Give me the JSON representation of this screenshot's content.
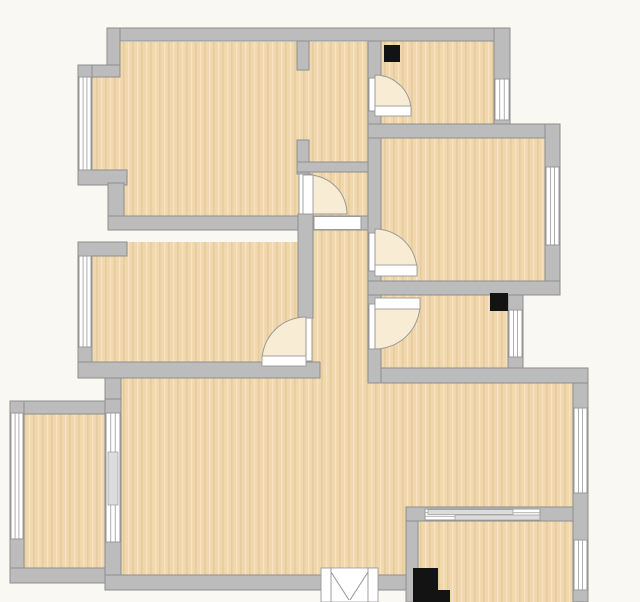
{
  "canvas": {
    "width": 640,
    "height": 602
  },
  "colors": {
    "background": "#faf8f2",
    "floor_base": "#f0d8ac",
    "floor_grain_light": "rgba(255,255,255,0.30)",
    "floor_grain_dark": "rgba(140,95,35,0.10)",
    "wall_fill": "#bcbcbc",
    "wall_stroke": "#8e8e8e",
    "opening_fill": "#ffffff",
    "frame_stroke": "#9a9a9a",
    "door_swing_fill": "#f8ecd4",
    "door_leaf_fill": "#ffffff",
    "fixture_black": "#131313",
    "glazing_block": "#dcdcdc"
  },
  "floors": [
    {
      "name": "floor-top-left-room",
      "type": "poly",
      "points": "120,42 368,42 368,230 108,230 108,185 92,185 92,77 120,77"
    },
    {
      "name": "floor-middle-left-room",
      "type": "rect",
      "x": 78,
      "y": 242,
      "w": 242,
      "h": 136
    },
    {
      "name": "floor-hall-strip",
      "type": "rect",
      "x": 309,
      "y": 162,
      "w": 72,
      "h": 221
    },
    {
      "name": "floor-top-right-room",
      "type": "rect",
      "x": 381,
      "y": 41,
      "w": 129,
      "h": 83
    },
    {
      "name": "floor-middle-right-room",
      "type": "rect",
      "x": 381,
      "y": 124,
      "w": 179,
      "h": 171
    },
    {
      "name": "floor-bathroom",
      "type": "rect",
      "x": 381,
      "y": 281,
      "w": 142,
      "h": 102
    },
    {
      "name": "floor-living-dining",
      "type": "poly",
      "points": "105,378 320,378 320,362 368,362 368,383 588,383 588,521 418,521 418,590 105,590"
    },
    {
      "name": "floor-kitchen",
      "type": "rect",
      "x": 406,
      "y": 507,
      "w": 182,
      "h": 95
    },
    {
      "name": "floor-balcony",
      "type": "rect",
      "x": 10,
      "y": 401,
      "w": 111,
      "h": 182
    }
  ],
  "walls": [
    {
      "name": "wall-top",
      "x": 107,
      "y": 28,
      "w": 403,
      "h": 13
    },
    {
      "name": "wall-left-upper",
      "x": 107,
      "y": 28,
      "w": 13,
      "h": 49
    },
    {
      "name": "wall-left-jog",
      "x": 78,
      "y": 65,
      "w": 42,
      "h": 12
    },
    {
      "name": "wall-left-window-top",
      "x": 78,
      "y": 65,
      "w": 14,
      "h": 120
    },
    {
      "name": "wall-left-cap-1",
      "x": 78,
      "y": 170,
      "w": 49,
      "h": 15
    },
    {
      "name": "wall-left-notch",
      "x": 108,
      "y": 183,
      "w": 16,
      "h": 47
    },
    {
      "name": "wall-topleft-room-bottom",
      "x": 108,
      "y": 216,
      "w": 273,
      "h": 14
    },
    {
      "name": "wall-left-cap-2",
      "x": 78,
      "y": 242,
      "w": 49,
      "h": 14
    },
    {
      "name": "wall-left-window-mid",
      "x": 78,
      "y": 256,
      "w": 14,
      "h": 106
    },
    {
      "name": "wall-middleleft-room-bottom",
      "x": 78,
      "y": 362,
      "w": 242,
      "h": 16
    },
    {
      "name": "wall-left-to-balcony",
      "x": 105,
      "y": 378,
      "w": 16,
      "h": 36
    },
    {
      "name": "wall-balcony-top",
      "x": 10,
      "y": 401,
      "w": 100,
      "h": 13
    },
    {
      "name": "wall-balcony-left",
      "x": 10,
      "y": 401,
      "w": 14,
      "h": 182
    },
    {
      "name": "wall-balcony-bottom",
      "x": 10,
      "y": 568,
      "w": 100,
      "h": 15
    },
    {
      "name": "wall-balcony-divider",
      "x": 105,
      "y": 399,
      "w": 16,
      "h": 191
    },
    {
      "name": "wall-living-bottom",
      "x": 105,
      "y": 575,
      "w": 313,
      "h": 15
    },
    {
      "name": "wall-kitchen-left",
      "x": 406,
      "y": 507,
      "w": 12,
      "h": 95
    },
    {
      "name": "wall-kitchen-partition",
      "x": 406,
      "y": 507,
      "w": 182,
      "h": 14
    },
    {
      "name": "wall-right-lower",
      "x": 573,
      "y": 368,
      "w": 15,
      "h": 234
    },
    {
      "name": "wall-bathroom-bottom",
      "x": 368,
      "y": 368,
      "w": 220,
      "h": 15
    },
    {
      "name": "wall-spine",
      "x": 368,
      "y": 41,
      "w": 13,
      "h": 342
    },
    {
      "name": "wall-stub-upper",
      "x": 297,
      "y": 41,
      "w": 12,
      "h": 29
    },
    {
      "name": "wall-stub-lower",
      "x": 297,
      "y": 140,
      "w": 12,
      "h": 34
    },
    {
      "name": "wall-hall-top",
      "x": 297,
      "y": 162,
      "w": 71,
      "h": 10
    },
    {
      "name": "wall-hall-west",
      "x": 298,
      "y": 214,
      "w": 15,
      "h": 104
    },
    {
      "name": "wall-topright-room-bottom",
      "x": 368,
      "y": 124,
      "w": 192,
      "h": 14
    },
    {
      "name": "wall-topright-right",
      "x": 494,
      "y": 28,
      "w": 16,
      "h": 96
    },
    {
      "name": "wall-middleright-right",
      "x": 545,
      "y": 124,
      "w": 15,
      "h": 171
    },
    {
      "name": "wall-middleright-bottom",
      "x": 368,
      "y": 281,
      "w": 192,
      "h": 14
    },
    {
      "name": "wall-bathroom-right",
      "x": 508,
      "y": 295,
      "w": 15,
      "h": 73
    }
  ],
  "openings": [
    {
      "name": "door-opening-top-right-room",
      "x": 369,
      "y": 78,
      "w": 11,
      "h": 33
    },
    {
      "name": "door-opening-hall-from-topleft",
      "x": 299,
      "y": 174,
      "w": 13,
      "h": 40
    },
    {
      "name": "pass-opening-hall",
      "x": 314,
      "y": 216.5,
      "w": 47,
      "h": 13
    },
    {
      "name": "door-opening-middleleft-room",
      "x": 300,
      "y": 318,
      "w": 12,
      "h": 43
    },
    {
      "name": "door-opening-middleright-room",
      "x": 369,
      "y": 233,
      "w": 11,
      "h": 38
    },
    {
      "name": "door-opening-bathroom",
      "x": 369,
      "y": 304,
      "w": 11,
      "h": 45
    }
  ],
  "doors": [
    {
      "name": "door-top-right-room",
      "swing": "M375,111 L375,75 A36,36 0 0 1 411,111 Z",
      "leaf": {
        "x": 375,
        "y": 106,
        "w": 36,
        "h": 10
      }
    },
    {
      "name": "door-hall",
      "swing": "M308,214 L308,175 A39,39 0 0 1 347,214 Z",
      "leaf": {
        "x": 303,
        "y": 175,
        "w": 10,
        "h": 39
      }
    },
    {
      "name": "door-middle-left-room",
      "swing": "M306,361 L306,317 A44,44 0 0 0 262,361 Z",
      "leaf": {
        "x": 262,
        "y": 356,
        "w": 44,
        "h": 10
      }
    },
    {
      "name": "door-middle-right-room",
      "swing": "M375,271 L375,229 A42,42 0 0 1 417,271 Z",
      "leaf": {
        "x": 375,
        "y": 265,
        "w": 42,
        "h": 11
      }
    },
    {
      "name": "door-bathroom",
      "swing": "M375,304 L420,304 A45,45 0 0 1 375,349 Z",
      "leaf": {
        "x": 375,
        "y": 298,
        "w": 45,
        "h": 11
      }
    }
  ],
  "windows": [
    {
      "name": "window-top-left-room",
      "x": 79,
      "y": 77,
      "w": 12,
      "h": 93,
      "orient": "v"
    },
    {
      "name": "window-middle-left-room",
      "x": 79,
      "y": 256,
      "w": 12,
      "h": 91,
      "orient": "v"
    },
    {
      "name": "window-balcony-left",
      "x": 11,
      "y": 413,
      "w": 12,
      "h": 126,
      "orient": "v"
    },
    {
      "name": "window-balcony-divider",
      "x": 106,
      "y": 413,
      "w": 14,
      "h": 129,
      "orient": "v"
    },
    {
      "name": "window-top-right-room",
      "x": 495,
      "y": 79,
      "w": 14,
      "h": 41,
      "orient": "v"
    },
    {
      "name": "window-middle-right-room",
      "x": 546,
      "y": 167,
      "w": 13,
      "h": 78,
      "orient": "v"
    },
    {
      "name": "window-bathroom",
      "x": 509,
      "y": 310,
      "w": 13,
      "h": 47,
      "orient": "v"
    },
    {
      "name": "window-dining-right",
      "x": 574,
      "y": 408,
      "w": 13,
      "h": 85,
      "orient": "v"
    },
    {
      "name": "window-kitchen-right",
      "x": 574,
      "y": 540,
      "w": 13,
      "h": 50,
      "orient": "v"
    },
    {
      "name": "window-kitchen-pass",
      "x": 425,
      "y": 509,
      "w": 115,
      "h": 11,
      "orient": "h"
    }
  ],
  "window_details": [
    {
      "name": "divider-glazing-block",
      "x": 108,
      "y": 452,
      "w": 10,
      "h": 53
    },
    {
      "name": "pass-slider-panel-1",
      "x": 428,
      "y": 509.5,
      "w": 85,
      "h": 5
    },
    {
      "name": "pass-slider-panel-2",
      "x": 455,
      "y": 515,
      "w": 85,
      "h": 5
    }
  ],
  "french_door": {
    "name": "french-door-living-balcony",
    "panel": {
      "x": 331,
      "y": 568,
      "w": 37,
      "h": 34
    },
    "jambs": [
      {
        "x": 321,
        "y": 568,
        "w": 10,
        "h": 34
      },
      {
        "x": 368,
        "y": 568,
        "w": 10,
        "h": 34
      }
    ],
    "flaps": [
      {
        "x1": 331,
        "y1": 572,
        "x2": 349,
        "y2": 600
      },
      {
        "x1": 368,
        "y1": 572,
        "x2": 350,
        "y2": 600
      }
    ]
  },
  "fixtures": [
    {
      "name": "shaft-top-right-room",
      "type": "rect",
      "x": 384,
      "y": 45,
      "w": 16,
      "h": 17
    },
    {
      "name": "shaft-bathroom",
      "type": "rect",
      "x": 490,
      "y": 293,
      "w": 18,
      "h": 18
    },
    {
      "name": "appliance-kitchen",
      "type": "path",
      "d": "M413,568 h25 v22 h12 v12 h-37 Z"
    }
  ]
}
